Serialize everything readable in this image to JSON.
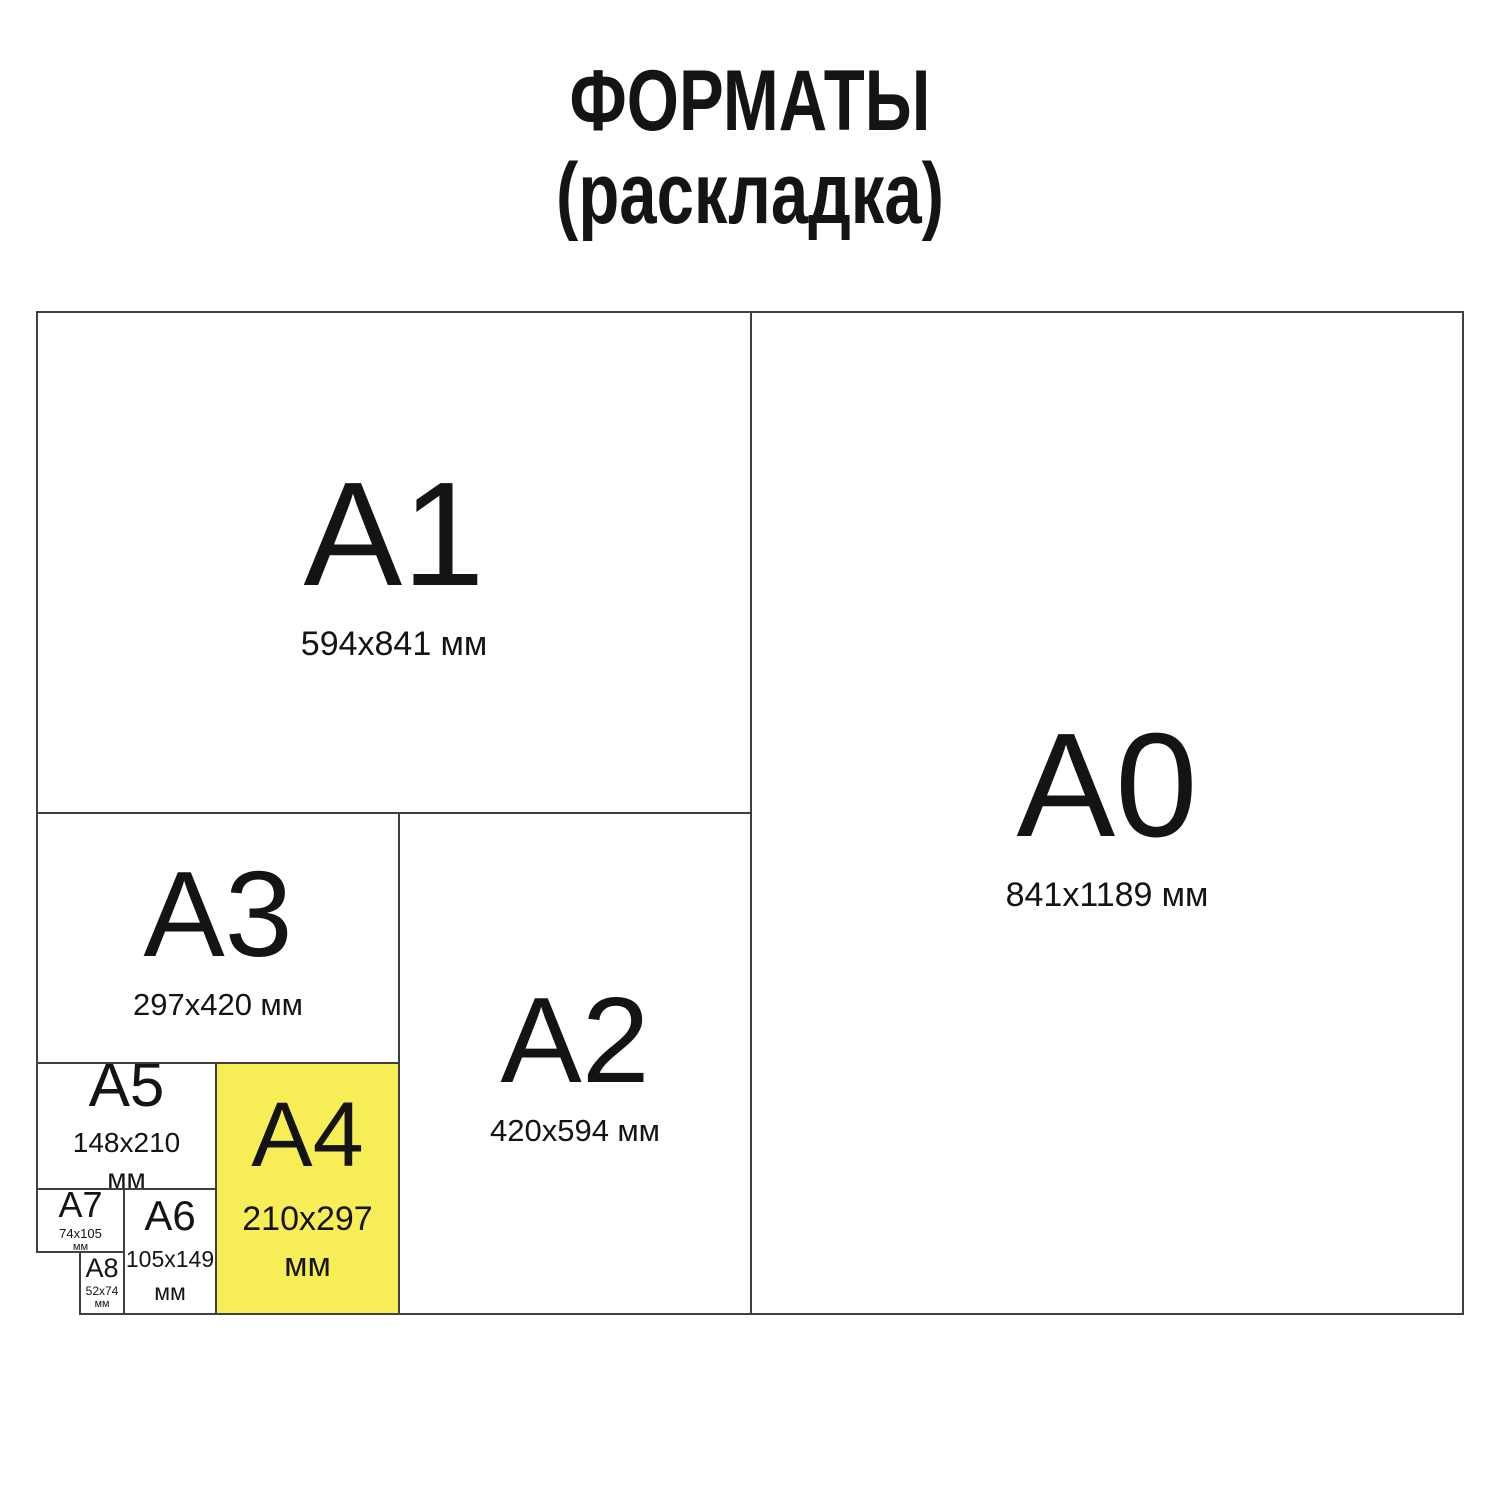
{
  "title": {
    "line1": "ФОРМАТЫ",
    "line2": "(раскладка)"
  },
  "colors": {
    "highlight": "#F7ED57",
    "line": "#404040",
    "text": "#141414",
    "page-bg": "#FFFFFF"
  },
  "formats": [
    {
      "id": "A1",
      "label": "A1",
      "dims": "594x841",
      "unit": "мм",
      "highlighted": false
    },
    {
      "id": "A0",
      "label": "A0",
      "dims": "841x1189",
      "unit": "мм",
      "highlighted": false
    },
    {
      "id": "A3",
      "label": "A3",
      "dims": "297x420",
      "unit": "мм",
      "highlighted": false
    },
    {
      "id": "A2",
      "label": "A2",
      "dims": "420x594",
      "unit": "мм",
      "highlighted": false
    },
    {
      "id": "A5",
      "label": "A5",
      "dims": "148x210",
      "unit": "мм",
      "highlighted": false
    },
    {
      "id": "A4",
      "label": "A4",
      "dims": "210x297",
      "unit": "мм",
      "highlighted": true
    },
    {
      "id": "A7",
      "label": "A7",
      "dims": "74x105",
      "unit": "мм",
      "highlighted": false
    },
    {
      "id": "A6",
      "label": "A6",
      "dims": "105x149",
      "unit": "мм",
      "highlighted": false
    },
    {
      "id": "A8",
      "label": "A8",
      "dims": "52x74",
      "unit": "мм",
      "highlighted": false
    }
  ]
}
